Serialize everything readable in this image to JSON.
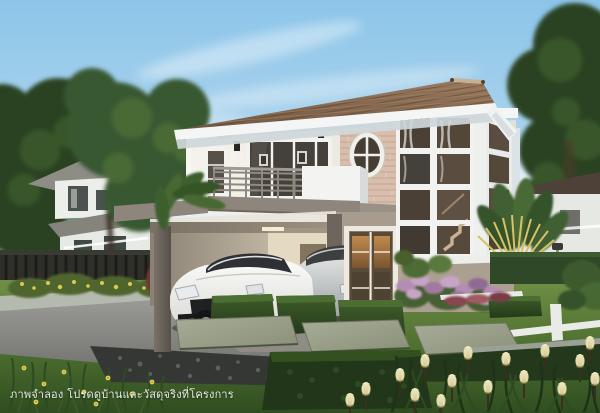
{
  "meta": {
    "alt": "Daytime architectural rendering of a modern two-storey detached house with balcony, oval window, two-storey glass staircase bay, carport with a white sports car and a silver sedan, and a manicured tropical garden with stepping stones, hedges and flowers",
    "width": 600,
    "height": 413
  },
  "caption": {
    "text": "ภาพจำลอง โปรดดูบ้านและวัสดุจริงที่โครงการ",
    "color": "#ffffff"
  },
  "palette": {
    "sky_top": "#8cc5e9",
    "sky_mid": "#b6d8ee",
    "sky_low": "#dcebf4",
    "sky_horizon": "#f2f6f8",
    "cloud": "#ffffff",
    "roof_dark": "#6f543f",
    "roof_light": "#97785e",
    "ridge": "#c7b195",
    "fascia": "#f4f6f5",
    "soffit": "#cfd7da",
    "wall_upper_light": "#f4f2ea",
    "wall_upper_dark": "#e4e0d4",
    "stone": "#d8bfad",
    "stone_line": "#c2a28e",
    "wall_lower": "#a89c8e",
    "band_gray": "#8e867c",
    "column_light": "#7a7268",
    "column_dark": "#57504a",
    "frame_white": "#f2f3f1",
    "glass_dark": "#45403a",
    "glass_warm_hi": "#c08a4e",
    "glass_warm_lo": "#7a5530",
    "tree_dark": "#2b4323",
    "tree_mid": "#395930",
    "tree_light": "#4e7038",
    "hedge_hi": "#3f5e2a",
    "hedge_lo": "#24391a",
    "lawn_hi": "#6f8f46",
    "lawn_mid": "#4e7030",
    "lawn_lo": "#2f4d20",
    "drive_hi": "#9c9c98",
    "drive_lo": "#70706c",
    "pebble": "#353735",
    "slab_hi": "#a7ac97",
    "slab_lo": "#8a9078",
    "curb": "#b5bab0",
    "edging": "#e9ece6",
    "fence": "#2f2f2a",
    "neighbor_wall": "#eceee9",
    "neighbor_roof": "#8d8d86",
    "flower_purple": "#b58cb4",
    "flower_yellow": "#ddc94f",
    "tulip_hi": "#f2ecc6",
    "tulip_lo": "#cfc28e",
    "car_white_hi": "#fbfbf9",
    "car_white_lo": "#d8d8d4",
    "car_silver_hi": "#e8eaea",
    "car_silver_lo": "#9fa3a6",
    "palm_gold": "#d9c264"
  }
}
